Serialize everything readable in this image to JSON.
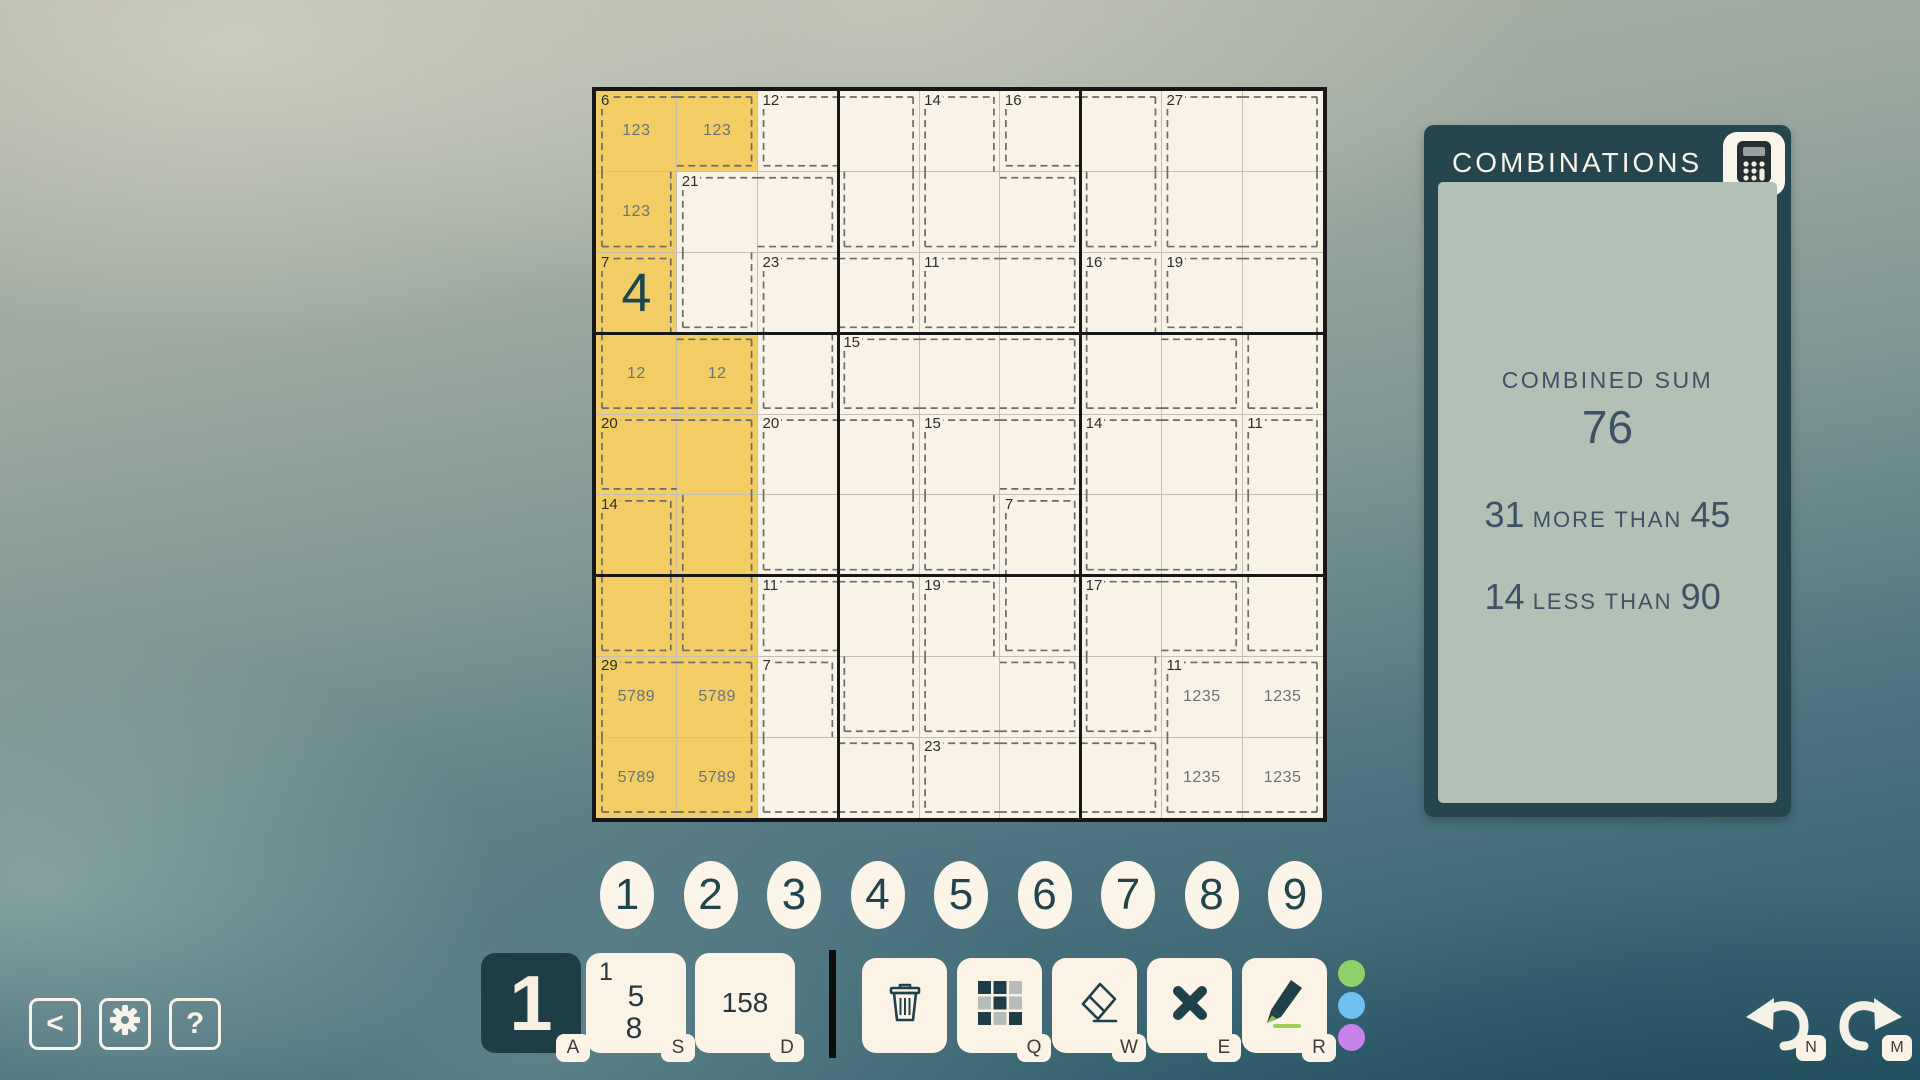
{
  "board": {
    "left": 596,
    "top": 91,
    "size": 727,
    "selected_cells": [
      [
        1,
        1
      ],
      [
        1,
        2
      ],
      [
        2,
        1
      ],
      [
        3,
        1
      ],
      [
        4,
        1
      ],
      [
        4,
        2
      ],
      [
        5,
        1
      ],
      [
        5,
        2
      ],
      [
        6,
        1
      ],
      [
        6,
        2
      ],
      [
        7,
        1
      ],
      [
        7,
        2
      ],
      [
        8,
        1
      ],
      [
        8,
        2
      ],
      [
        9,
        1
      ],
      [
        9,
        2
      ]
    ],
    "values": [
      {
        "r": 3,
        "c": 1,
        "value": "4"
      }
    ],
    "pencils": [
      {
        "r": 1,
        "c": 1,
        "text": "123"
      },
      {
        "r": 1,
        "c": 2,
        "text": "123"
      },
      {
        "r": 2,
        "c": 1,
        "text": "123"
      },
      {
        "r": 4,
        "c": 1,
        "text": "12"
      },
      {
        "r": 4,
        "c": 2,
        "text": "12"
      },
      {
        "r": 8,
        "c": 1,
        "text": "5789"
      },
      {
        "r": 8,
        "c": 2,
        "text": "5789"
      },
      {
        "r": 9,
        "c": 1,
        "text": "5789"
      },
      {
        "r": 9,
        "c": 2,
        "text": "5789"
      },
      {
        "r": 8,
        "c": 8,
        "text": "1235"
      },
      {
        "r": 8,
        "c": 9,
        "text": "1235"
      },
      {
        "r": 9,
        "c": 8,
        "text": "1235"
      },
      {
        "r": 9,
        "c": 9,
        "text": "1235"
      }
    ],
    "cages": [
      {
        "sum": "6",
        "cells": [
          [
            1,
            1
          ],
          [
            1,
            2
          ],
          [
            2,
            1
          ]
        ]
      },
      {
        "sum": "12",
        "cells": [
          [
            1,
            3
          ],
          [
            1,
            4
          ],
          [
            2,
            4
          ]
        ]
      },
      {
        "sum": "14",
        "cells": [
          [
            1,
            5
          ],
          [
            2,
            5
          ],
          [
            2,
            6
          ]
        ]
      },
      {
        "sum": "16",
        "cells": [
          [
            1,
            6
          ],
          [
            1,
            7
          ],
          [
            2,
            7
          ]
        ]
      },
      {
        "sum": "27",
        "cells": [
          [
            1,
            8
          ],
          [
            1,
            9
          ],
          [
            2,
            8
          ],
          [
            2,
            9
          ]
        ]
      },
      {
        "sum": "21",
        "cells": [
          [
            2,
            2
          ],
          [
            2,
            3
          ],
          [
            3,
            2
          ]
        ]
      },
      {
        "sum": "7",
        "cells": [
          [
            3,
            1
          ],
          [
            4,
            1
          ],
          [
            4,
            2
          ]
        ]
      },
      {
        "sum": "23",
        "cells": [
          [
            3,
            3
          ],
          [
            3,
            4
          ],
          [
            4,
            3
          ]
        ]
      },
      {
        "sum": "11",
        "cells": [
          [
            3,
            5
          ],
          [
            3,
            6
          ]
        ]
      },
      {
        "sum": "16",
        "cells": [
          [
            3,
            7
          ],
          [
            4,
            7
          ],
          [
            4,
            8
          ]
        ]
      },
      {
        "sum": "19",
        "cells": [
          [
            3,
            8
          ],
          [
            3,
            9
          ],
          [
            4,
            9
          ]
        ]
      },
      {
        "sum": "15",
        "cells": [
          [
            4,
            4
          ],
          [
            4,
            5
          ],
          [
            4,
            6
          ]
        ]
      },
      {
        "sum": "20",
        "cells": [
          [
            5,
            1
          ],
          [
            5,
            2
          ],
          [
            6,
            2
          ],
          [
            7,
            2
          ]
        ]
      },
      {
        "sum": "20",
        "cells": [
          [
            5,
            3
          ],
          [
            5,
            4
          ],
          [
            6,
            3
          ],
          [
            6,
            4
          ]
        ]
      },
      {
        "sum": "15",
        "cells": [
          [
            5,
            5
          ],
          [
            5,
            6
          ],
          [
            6,
            5
          ]
        ]
      },
      {
        "sum": "14",
        "cells": [
          [
            5,
            7
          ],
          [
            5,
            8
          ],
          [
            6,
            7
          ],
          [
            6,
            8
          ]
        ]
      },
      {
        "sum": "11",
        "cells": [
          [
            5,
            9
          ],
          [
            6,
            9
          ],
          [
            7,
            9
          ]
        ]
      },
      {
        "sum": "14",
        "cells": [
          [
            6,
            1
          ],
          [
            7,
            1
          ]
        ]
      },
      {
        "sum": "7",
        "cells": [
          [
            6,
            6
          ],
          [
            7,
            6
          ]
        ]
      },
      {
        "sum": "11",
        "cells": [
          [
            7,
            3
          ],
          [
            7,
            4
          ],
          [
            8,
            4
          ]
        ]
      },
      {
        "sum": "19",
        "cells": [
          [
            7,
            5
          ],
          [
            8,
            5
          ],
          [
            8,
            6
          ]
        ]
      },
      {
        "sum": "17",
        "cells": [
          [
            7,
            7
          ],
          [
            7,
            8
          ],
          [
            8,
            7
          ]
        ]
      },
      {
        "sum": "29",
        "cells": [
          [
            8,
            1
          ],
          [
            8,
            2
          ],
          [
            9,
            1
          ],
          [
            9,
            2
          ]
        ]
      },
      {
        "sum": "7",
        "cells": [
          [
            8,
            3
          ],
          [
            9,
            3
          ],
          [
            9,
            4
          ]
        ]
      },
      {
        "sum": "11",
        "cells": [
          [
            8,
            8
          ],
          [
            8,
            9
          ],
          [
            9,
            8
          ],
          [
            9,
            9
          ]
        ]
      },
      {
        "sum": "23",
        "cells": [
          [
            9,
            5
          ],
          [
            9,
            6
          ],
          [
            9,
            7
          ]
        ]
      }
    ]
  },
  "panel": {
    "title": "COMBINATIONS",
    "icon": "calculator-icon",
    "combined_sum_label": "COMBINED SUM",
    "combined_sum": "76",
    "comparisons": [
      {
        "a": "31",
        "rel": " MORE THAN ",
        "b": "45"
      },
      {
        "a": "14",
        "rel": " LESS THAN ",
        "b": "90"
      }
    ]
  },
  "number_row": [
    "1",
    "2",
    "3",
    "4",
    "5",
    "6",
    "7",
    "8",
    "9"
  ],
  "toolbar": {
    "digit_button": {
      "label": "1",
      "hint": "A",
      "state": "selected"
    },
    "corner_marks_button": {
      "marks": [
        "1",
        "5",
        "8"
      ],
      "hint": "S"
    },
    "center_marks_button": {
      "label": "158",
      "hint": "D"
    },
    "tools": [
      {
        "name": "delete-button",
        "icon": "trash-icon",
        "hint": ""
      },
      {
        "name": "grid-marks-button",
        "icon": "grid-icon",
        "hint": "Q"
      },
      {
        "name": "eraser-button",
        "icon": "eraser-icon",
        "hint": "W"
      },
      {
        "name": "clear-button",
        "icon": "x-icon",
        "hint": "E"
      },
      {
        "name": "marker-button",
        "icon": "marker-icon",
        "hint": "R"
      }
    ],
    "color_dots": [
      "#8fd06a",
      "#70bff1",
      "#c783ea"
    ]
  },
  "nav": {
    "back_label": "<",
    "help_label": "?"
  },
  "history": {
    "undo_hint": "N",
    "redo_hint": "M"
  },
  "colors": {
    "cell_bg": "#f9f2e6",
    "selection": "#f1cd63",
    "cage_dash": "#6b6b6b",
    "value": "#1c4653",
    "panel_frame": "#26464f",
    "panel_inner": "#b3c0b6",
    "panel_text": "#3e5266",
    "button_cream": "#fbf3e6",
    "button_dark": "#1e3e45"
  }
}
